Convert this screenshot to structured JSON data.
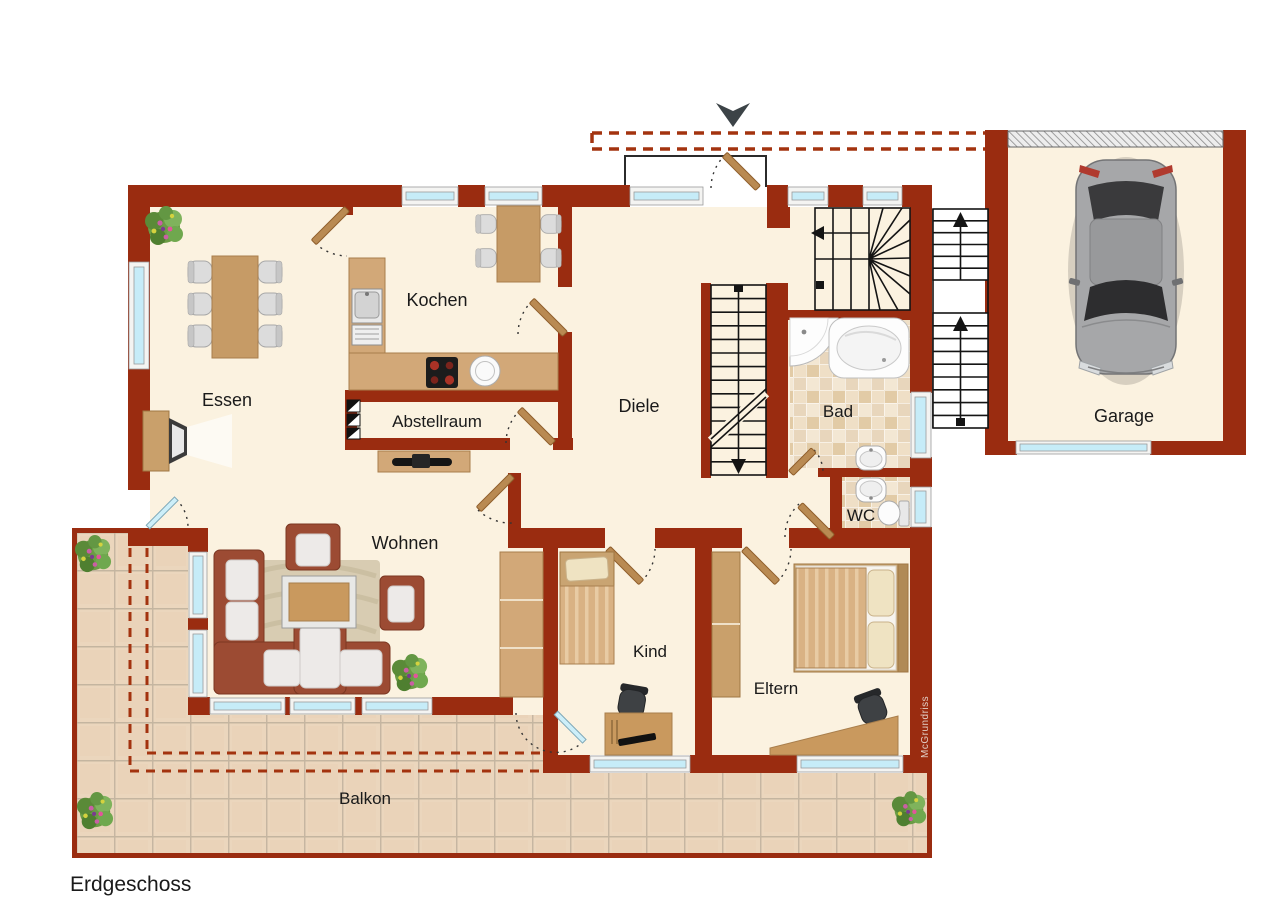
{
  "title": {
    "floor_label": "Erdgeschoss"
  },
  "watermark": {
    "label": "McGrundriss"
  },
  "rooms": {
    "essen": "Essen",
    "kochen": "Kochen",
    "abstellraum": "Abstellraum",
    "diele": "Diele",
    "bad": "Bad",
    "wc": "WC",
    "wohnen": "Wohnen",
    "kind": "Kind",
    "eltern": "Eltern",
    "balkon": "Balkon",
    "garage": "Garage"
  },
  "colors": {
    "wall": "#9A2C10",
    "floor": "#FBF2E0",
    "balcony_tile": "#EBD6BD",
    "bath_tile": "#E8D5B8",
    "window_glass": "#C6ECF8",
    "door_wood": "#B98A52",
    "dashed_outline": "#A3330F"
  }
}
